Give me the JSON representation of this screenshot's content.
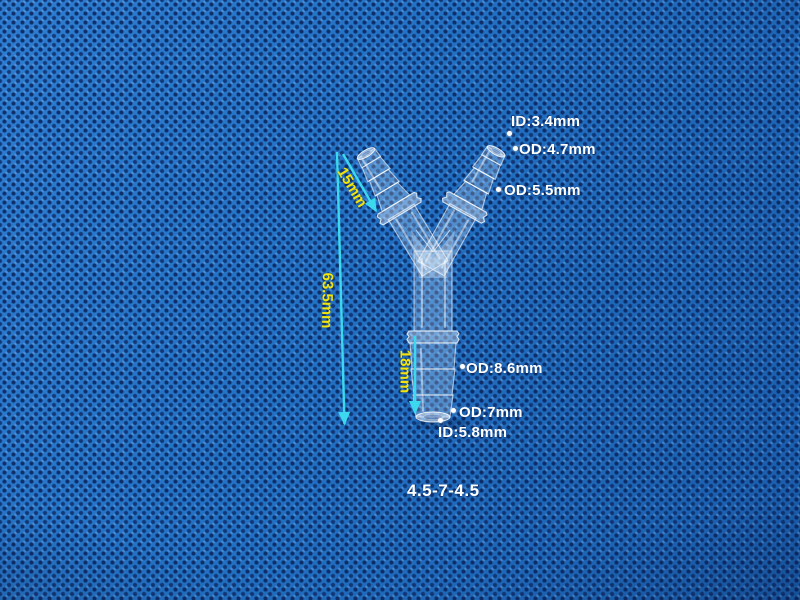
{
  "scene": {
    "description": "Transparent Y-shaped plastic hose barb connector photographed on blue non-woven fabric"
  },
  "labels": {
    "id_top": "ID:3.4mm",
    "od_top": "OD:4.7mm",
    "od_right": "OD:5.5mm",
    "od_stem_upper": "OD:8.6mm",
    "od_stem_lower": "OD:7mm",
    "id_bottom": "ID:5.8mm"
  },
  "dimensions": {
    "arm_length": "15mm",
    "total_height": "63.5mm",
    "stem_length": "18mm"
  },
  "product_code": "4.5-7-4.5",
  "colors": {
    "background_blue": "#2271c4",
    "fabric_dot_navy": "#0c2862",
    "label_text": "#ffffff",
    "dimension_text": "#f2e40c",
    "arrow_cyan": "#3cd8ee"
  }
}
